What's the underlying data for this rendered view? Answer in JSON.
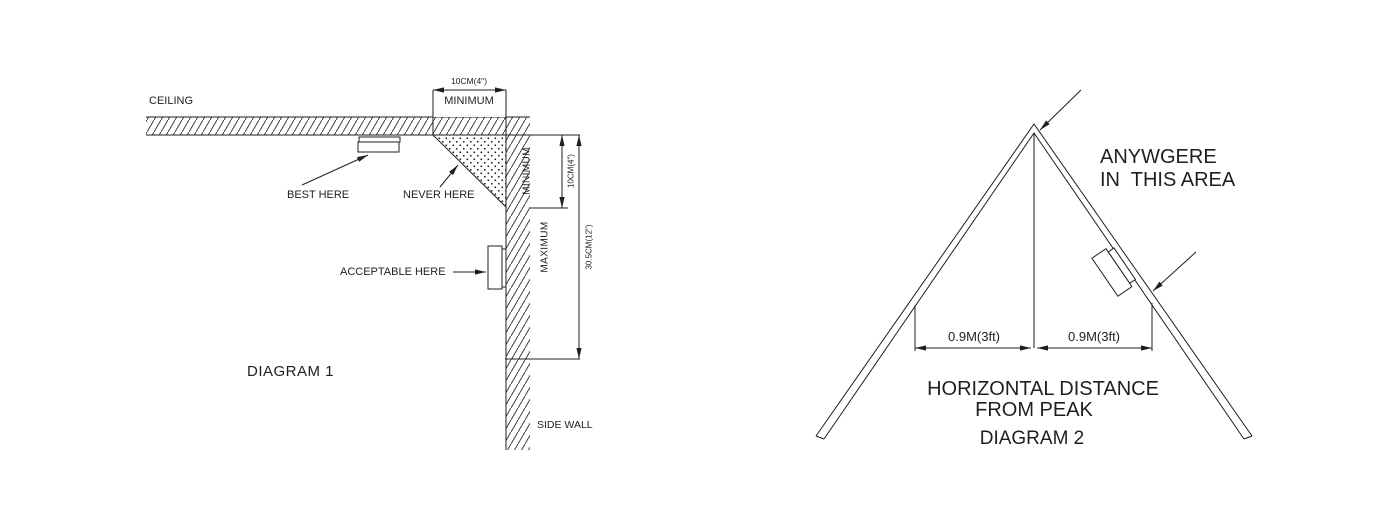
{
  "diagram1": {
    "title": "DIAGRAM 1",
    "labels": {
      "ceiling": "CEILING",
      "side_wall": "SIDE WALL",
      "best_here": "BEST HERE",
      "never_here": "NEVER HERE",
      "acceptable_here": "ACCEPTABLE HERE"
    },
    "dimensions": {
      "top_value": "10CM(4\")",
      "top_label": "MINIMUM",
      "wall_min_label": "MINIMUM",
      "wall_min_value": "10CM(4\")",
      "wall_max_label": "MAXIMUM",
      "wall_max_value": "30.5CM(12\")"
    }
  },
  "diagram2": {
    "title": "DIAGRAM 2",
    "labels": {
      "anywhere_line1": "ANYWGERE",
      "anywhere_line2": "IN  THIS AREA",
      "caption_line1": "HORIZONTAL DISTANCE",
      "caption_line2": "FROM PEAK"
    },
    "dimensions": {
      "left": "0.9M(3ft)",
      "right": "0.9M(3ft)"
    }
  },
  "colors": {
    "line": "#1f1f1f",
    "background": "#ffffff"
  }
}
